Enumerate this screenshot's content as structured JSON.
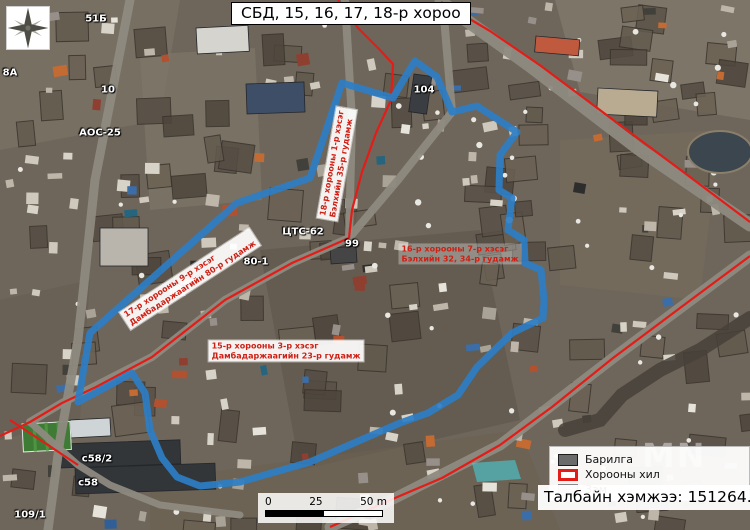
{
  "title": "СБД, 15, 16, 17, 18-р хороо",
  "colors": {
    "boundary_blue": "#2d7ec6",
    "road_red": "#e41c18",
    "highlight_cyan": "#45d6e2"
  },
  "street_labels": [
    {
      "line1": "17-р хорооны 9-р хэсэг",
      "line2": "Дамбадаржаагийн 80-р гудамж",
      "x": 190,
      "y": 279,
      "rotation": -33,
      "bg": true
    },
    {
      "line1": "18-р хорооны 1-р хэсэг",
      "line2": "Бэлхийн 35-р гудамж",
      "x": 337,
      "y": 164,
      "rotation": -80,
      "bg": true
    },
    {
      "line1": "16-р хорооны 7-р хэсэг",
      "line2": "Бэлхийн 32, 34-р гудамж",
      "x": 460,
      "y": 254,
      "rotation": 0,
      "bg": false
    },
    {
      "line1": "15-р хорооны 3-р хэсэг",
      "line2": "Дамбадаржаагийн 23-р гудамж",
      "x": 286,
      "y": 351,
      "rotation": 0,
      "bg": true
    }
  ],
  "small_labels": [
    {
      "text": "51Б",
      "x": 96,
      "y": 19
    },
    {
      "text": "8А",
      "x": 10,
      "y": 73
    },
    {
      "text": "10",
      "x": 108,
      "y": 90
    },
    {
      "text": "АОС-25",
      "x": 100,
      "y": 133
    },
    {
      "text": "104",
      "x": 424,
      "y": 90
    },
    {
      "text": "ЦТС-62",
      "x": 303,
      "y": 232
    },
    {
      "text": "99",
      "x": 352,
      "y": 244
    },
    {
      "text": "80-1",
      "x": 256,
      "y": 262
    },
    {
      "text": "с58/2",
      "x": 97,
      "y": 459
    },
    {
      "text": "с58",
      "x": 88,
      "y": 483
    },
    {
      "text": "109/1",
      "x": 30,
      "y": 515
    }
  ],
  "legend": {
    "items": [
      {
        "label": "Барилга",
        "icon": "building-swatch"
      },
      {
        "label": "Хорооны хил",
        "icon": "boundary-swatch"
      },
      {
        "label": "Зам",
        "icon": "road-swatch"
      }
    ]
  },
  "area_text": "Талбайн хэмжээ: 151264.3 м2",
  "scale": {
    "t0": "0",
    "t25": "25",
    "t50": "50 m"
  },
  "watermark": "MN",
  "boundary_points": "342,83 393,98 404,79 415,61 437,77 452,112 477,106 517,132 500,155 499,190 512,198 508,230 524,240 525,263 541,270 544,300 543,318 512,333 477,367 458,395 428,413 400,423 310,462 240,482 200,486 177,477 162,458 150,430 145,393 132,373 78,402 90,333 237,203 310,178",
  "red_roads": [
    "338,0 358,28 380,50 393,64 391,100 376,133 362,172 352,210 349,238",
    "349,238 292,263 225,300 152,357 96,387 62,403 30,422 0,436",
    "441,2 490,31 541,66 616,122 678,168 750,222",
    "750,256 688,302 613,358 552,407 500,445 442,478 395,498 330,527",
    "10,420 45,443 78,465"
  ],
  "highlight_parcel": "472,463 515,460 521,479 477,482"
}
